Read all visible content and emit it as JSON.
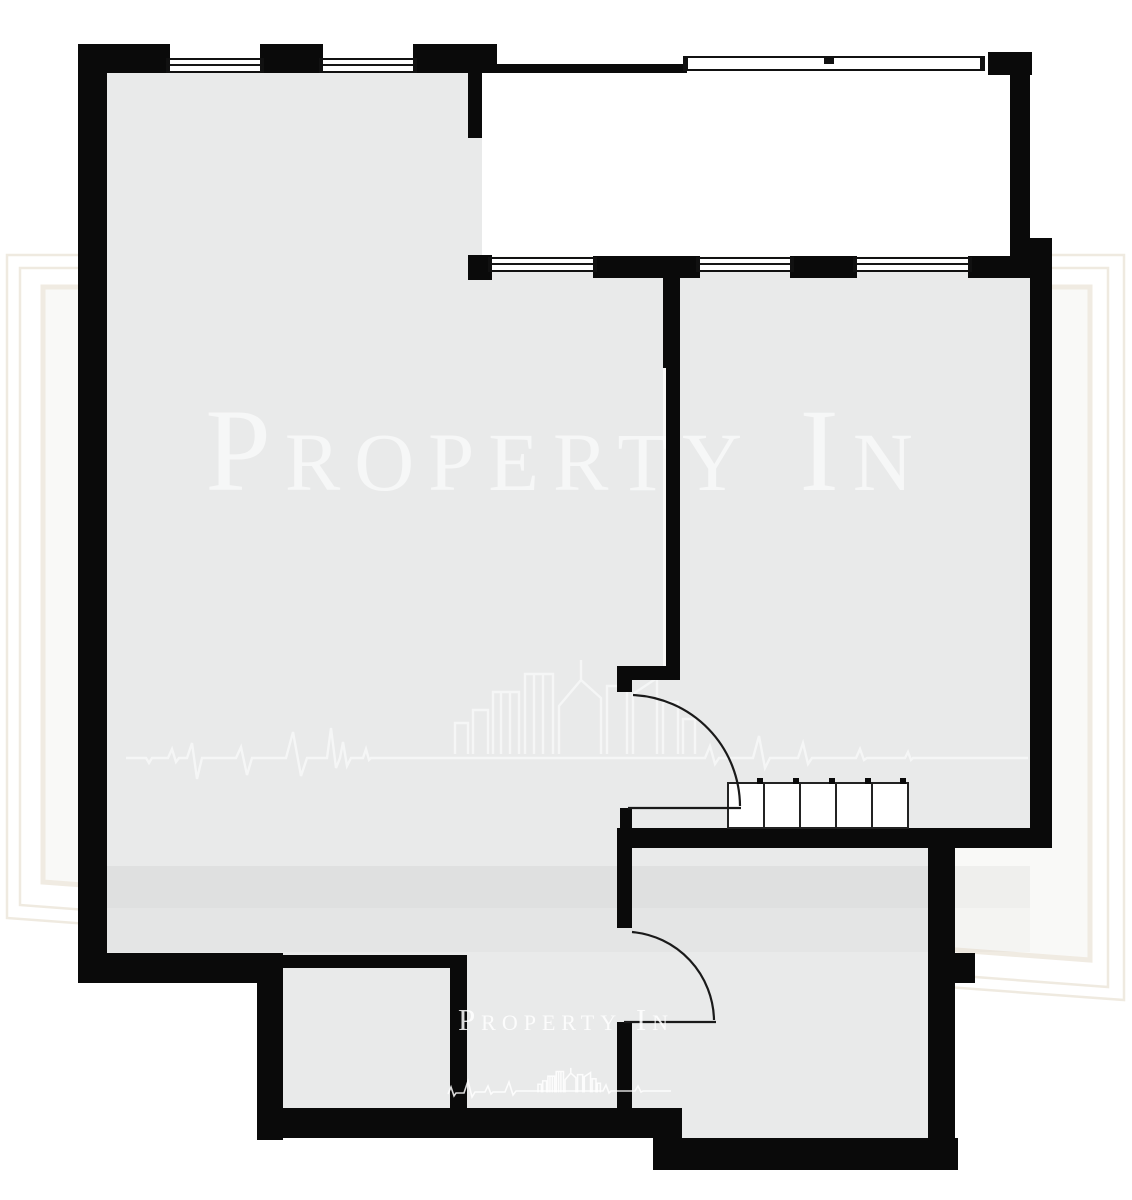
{
  "watermark": {
    "brand_text": "Property In",
    "footer_text": "Property In",
    "logo_icons": [
      "city-buildings-icon",
      "heartbeat-line-icon",
      "picture-frame-icon"
    ]
  },
  "colors": {
    "background": "#ffffff",
    "wall": "#0a0a0a",
    "floor": "#e9eaea",
    "floor_shadow_band": "rgba(0,0,0,0.04)",
    "watermark_text": "rgba(255,255,255,0.60)",
    "watermark_footer_text": "rgba(255,255,255,0.85)",
    "frame_watermark": "#ece6da",
    "window_glazing": "#ffffff",
    "door_stroke": "#1a1a1a"
  },
  "plan": {
    "type": "apartment-floor-plan",
    "top_wall_windows": 2,
    "mid_wall_windows": 3,
    "balcony_rail_segments": 1,
    "interior_door_swings": 2,
    "wardrobe_sections": 5,
    "rooms_shaded": 4,
    "balcony_unshaded": 1
  }
}
